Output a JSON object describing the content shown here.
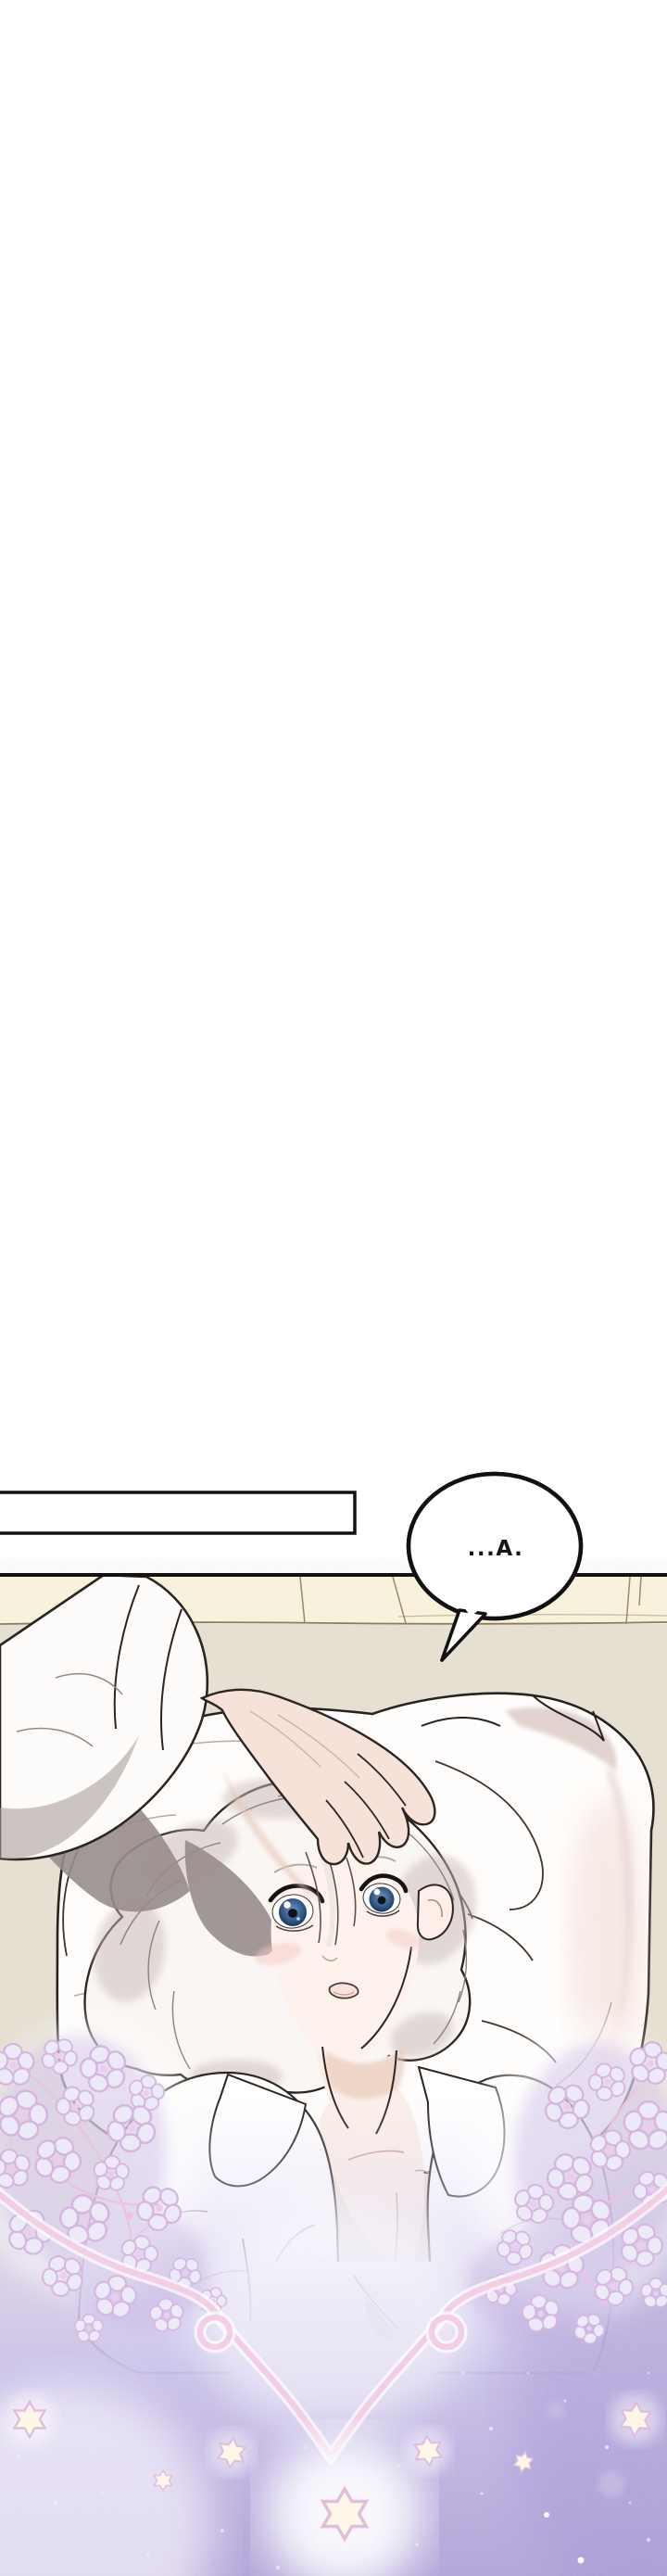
{
  "page": {
    "kind_label": "comic-panel",
    "background": "#ffffff"
  },
  "speech_bubble": {
    "text": "...A."
  },
  "caption_box": {
    "text": ""
  },
  "palette": {
    "ink": "#1c1815",
    "wall_cream": "#f8f1dc",
    "bed_beige": "#e9e3d6",
    "skin": "#f6e2d9",
    "hair_white": "#faf6f3",
    "hair_shadow": "#c9bab6",
    "sleeve_shadow": "#988d8b",
    "eye_blue": "#3b608f",
    "blush_pink": "#f6c9c6",
    "pillow_shade_mauve": "#dcc9c4",
    "flower_fill": "#ece9f8",
    "flower_outline": "#d6b5e0",
    "lace_pink": "#f2cde4",
    "vine_pink": "#ecc3df",
    "fog_lavender_light": "#e8e3f7",
    "fog_lavender_deep": "#b2a5d8",
    "star_cream": "#fcf7e7",
    "star_outline": "#e0bcdb"
  },
  "decorations": {
    "star_count": 7,
    "flower_cluster_count": 2
  }
}
